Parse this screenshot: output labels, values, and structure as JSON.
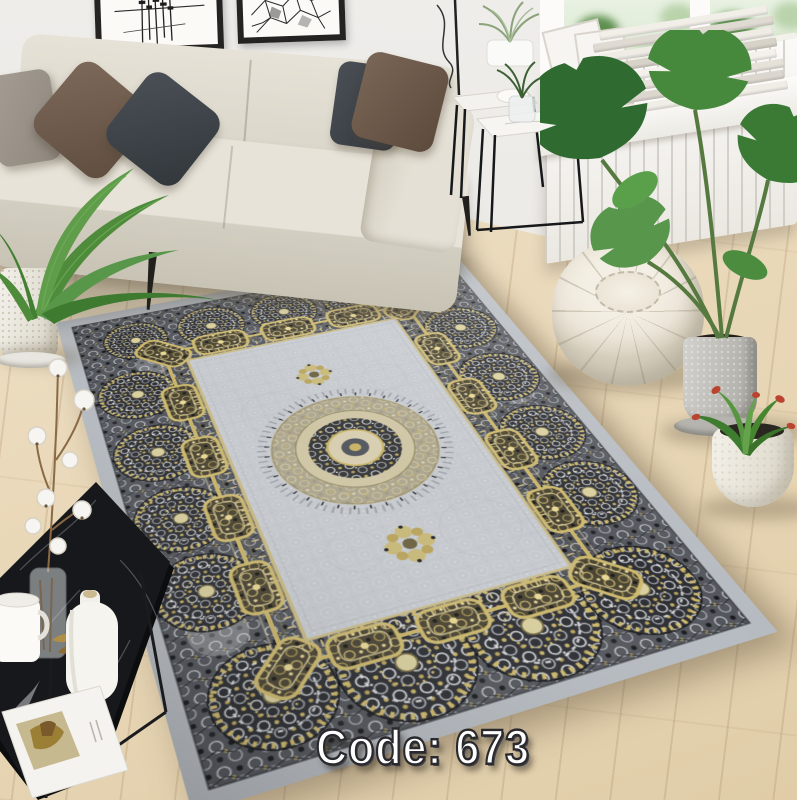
{
  "caption": {
    "text": "Code: 673",
    "fill": "#ffffff",
    "outline": "#2a2a2e"
  },
  "scene": {
    "type": "product-photo",
    "subject": "gray and gold medallion area rug styled in a scandinavian living room",
    "colors": {
      "wall": "#eceae6",
      "right_wall": "#f4f2ee",
      "wood_floor": "#ead9ba",
      "rug_band": "#b6bbc1",
      "rug_field": "#c6cad0",
      "rug_dark": "#2e3136",
      "accent_gold": "#c9b469",
      "sofa": "#e2ded3",
      "pouf": "#ece6d9",
      "leaf_green": "#4e8b3a"
    },
    "objects": [
      "abstract-wall-art-frames",
      "beige-sofa-with-pillows",
      "palm-plant-in-white-pot",
      "wire-floor-lamp",
      "nesting-marble-side-tables",
      "window-with-greenery",
      "magazine-stack-on-sill",
      "white-radiator",
      "moroccan-leather-pouf",
      "monstera-plant-in-concrete-pot",
      "red-green-plant-in-white-pot",
      "medallion-rug-gray-gold",
      "black-marble-coffee-table",
      "cotton-branch-in-glass-vase",
      "white-mug-and-bottle-vase",
      "open-magazine"
    ]
  }
}
